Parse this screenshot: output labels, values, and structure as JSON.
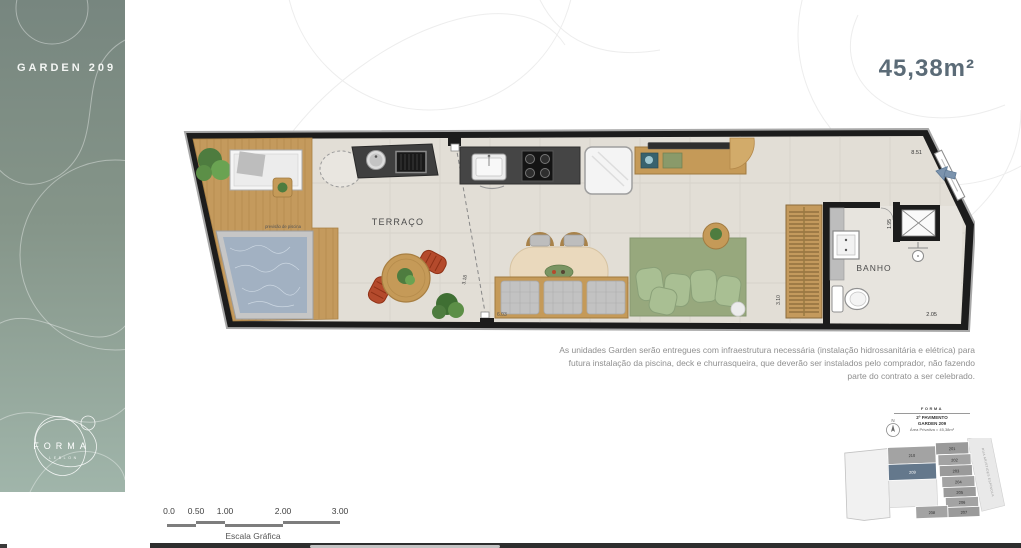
{
  "sidebar": {
    "unit_label": "GARDEN 209",
    "logo_primary": "FORMA",
    "logo_secondary": "LEBLON"
  },
  "area_badge": {
    "value": "45,38m²"
  },
  "floor_plan": {
    "room_labels": {
      "terrace": "TERRAÇO",
      "bathroom": "BANHO"
    },
    "annotations": {
      "pool_note": "previsão de piscina"
    },
    "dimensions": {
      "top_width": "8.51",
      "entry_depth": "1.95",
      "closet_depth": "3.10",
      "bath_width": "2.05",
      "living_width": "6.03",
      "terrace_opening": "3.18"
    }
  },
  "disclaimer": {
    "text": "As unidades Garden serão entregues com infraestrutura necessária (instalação hidrossanitária e elétrica) para futura instalação da piscina, deck e churrasqueira, que deverão ser instalados pelo comprador, não fazendo parte do contrato a ser celebrado."
  },
  "scale_bar": {
    "ticks": [
      "0.0",
      "0.50",
      "1.00",
      "2.00",
      "3.00"
    ],
    "label": "Escala Gráfica"
  },
  "key_plan": {
    "brand": "FORMA",
    "floor_label": "2º PAVIMENTO",
    "unit_label": "GARDEN 209",
    "area_label": "Área Privativa = 45,38m²",
    "compass": "N",
    "street_label": "RUA ARISTIDES ESPÍNOLA",
    "highlighted_unit": "209",
    "units": [
      {
        "id": "201"
      },
      {
        "id": "202"
      },
      {
        "id": "203"
      },
      {
        "id": "204"
      },
      {
        "id": "205"
      },
      {
        "id": "206"
      },
      {
        "id": "207"
      },
      {
        "id": "208"
      },
      {
        "id": "209"
      },
      {
        "id": "210"
      }
    ]
  },
  "colors": {
    "sidebar_top": "#77867f",
    "sidebar_bottom": "#a0b5aa",
    "area_text": "#5b6b77",
    "wall": "#1c1c1c",
    "wood": "#c49a5d",
    "pool_water": "#a2b1c2",
    "terrace_floor": "#e2ded6",
    "rug": "#97a87d",
    "sofa_cushion": "#a9bf93",
    "chair_red": "#b44a2c",
    "keyplan_highlight": "#64788c"
  }
}
